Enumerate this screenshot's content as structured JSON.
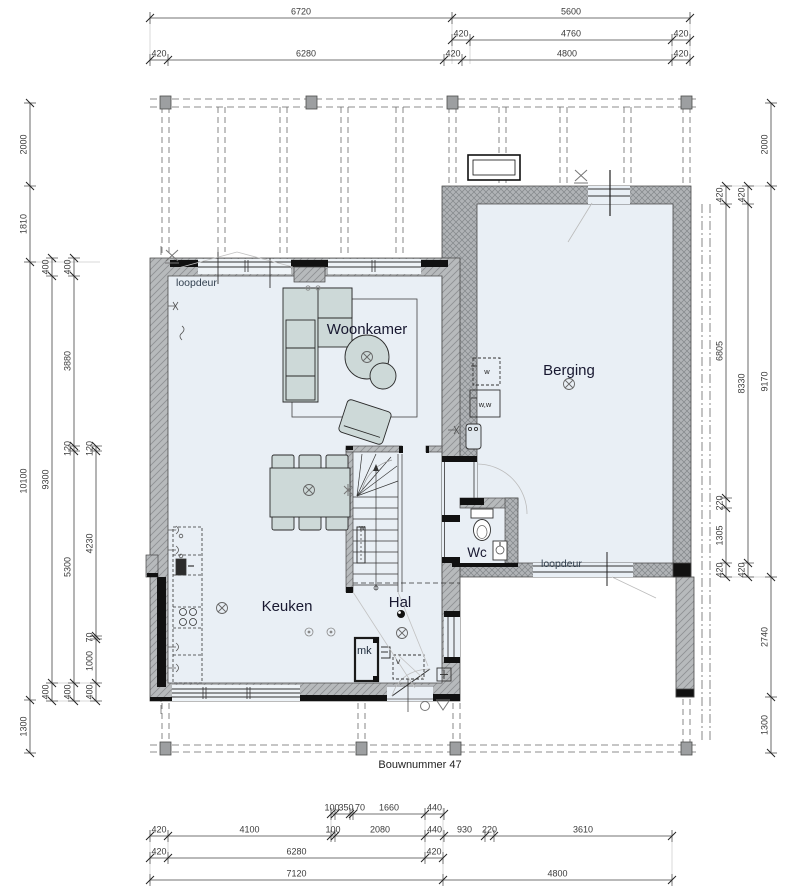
{
  "drawing": {
    "type": "floorplan-ground-floor",
    "building_label": "Bouwnummer 47"
  },
  "colors": {
    "floor": "#e9eff5",
    "wall_fill": "#b7babc",
    "wall_dark": "#111111",
    "furniture": "#cdd9d8",
    "dim_text": "#3b3b3b",
    "room_label": "#181830",
    "small_label": "#32404f"
  },
  "texts": [
    {
      "t": "Woonkamer",
      "x": 367,
      "y": 334,
      "s": 15,
      "c": "#181830",
      "n": "room-label-woonkamer"
    },
    {
      "t": "Berging",
      "x": 569,
      "y": 375,
      "s": 15,
      "c": "#181830",
      "n": "room-label-berging"
    },
    {
      "t": "Keuken",
      "x": 287,
      "y": 611,
      "s": 15,
      "c": "#181830",
      "n": "room-label-keuken"
    },
    {
      "t": "Hal",
      "x": 400,
      "y": 607,
      "s": 15,
      "c": "#181830",
      "n": "room-label-hal"
    },
    {
      "t": "Wc",
      "x": 477,
      "y": 557,
      "s": 13.5,
      "c": "#181830",
      "n": "room-label-wc"
    },
    {
      "t": "loopdeur",
      "x": 176,
      "y": 286,
      "s": 10.5,
      "c": "#32404f",
      "anchor": "start",
      "n": "label-loopdeur-front"
    },
    {
      "t": "loopdeur",
      "x": 541,
      "y": 567,
      "s": 10.5,
      "c": "#32404f",
      "anchor": "start",
      "n": "label-loopdeur-berging"
    },
    {
      "t": "mk",
      "x": 357,
      "y": 654,
      "s": 11,
      "c": "#1c2a3a",
      "anchor": "start",
      "n": "label-mk"
    },
    {
      "t": "v",
      "x": 396,
      "y": 664,
      "s": 8.5,
      "c": "#333333",
      "anchor": "start",
      "n": "label-v"
    },
    {
      "t": "w",
      "x": 487,
      "y": 374,
      "s": 7.5,
      "c": "#222222",
      "n": "label-w-appliance"
    },
    {
      "t": "w,w",
      "x": 485,
      "y": 407,
      "s": 7.5,
      "c": "#222222",
      "n": "label-ww-appliance"
    },
    {
      "t": "w",
      "x": 362,
      "y": 530,
      "s": 7,
      "c": "#222222",
      "n": "label-stair-w"
    },
    {
      "t": "Bouwnummer 47",
      "x": 420,
      "y": 768,
      "s": 11,
      "c": "#222222",
      "n": "label-bouwnummer"
    }
  ],
  "dimensions": {
    "chains": [
      {
        "name": "top-row-1",
        "orient": "h",
        "line": 18,
        "segs": [
          {
            "t": "6720",
            "a": 150,
            "b": 452
          },
          {
            "t": "5600",
            "a": 452,
            "b": 690
          }
        ]
      },
      {
        "name": "top-row-2",
        "orient": "h",
        "line": 40,
        "segs": [
          {
            "t": "420",
            "a": 452,
            "b": 470
          },
          {
            "t": "4760",
            "a": 470,
            "b": 672
          },
          {
            "t": "420",
            "a": 672,
            "b": 690
          }
        ]
      },
      {
        "name": "top-row-3",
        "orient": "h",
        "line": 60,
        "segs": [
          {
            "t": "420",
            "a": 150,
            "b": 168
          },
          {
            "t": "6280",
            "a": 168,
            "b": 444
          },
          {
            "t": "420",
            "a": 444,
            "b": 462
          },
          {
            "t": "4800",
            "a": 462,
            "b": 672
          },
          {
            "t": "420",
            "a": 672,
            "b": 690
          }
        ]
      },
      {
        "name": "bottom-row-1",
        "orient": "h",
        "line": 814,
        "segs": [
          {
            "t": "100",
            "a": 331,
            "b": 335,
            "lx": 332
          },
          {
            "t": "350",
            "a": 335,
            "b": 350,
            "lx": 346
          },
          {
            "t": "70",
            "a": 350,
            "b": 353,
            "lx": 360
          },
          {
            "t": "1660",
            "a": 353,
            "b": 425
          },
          {
            "t": "440",
            "a": 425,
            "b": 444
          }
        ]
      },
      {
        "name": "bottom-row-2",
        "orient": "h",
        "line": 836,
        "segs": [
          {
            "t": "420",
            "a": 150,
            "b": 168
          },
          {
            "t": "4100",
            "a": 168,
            "b": 331
          },
          {
            "t": "100",
            "a": 331,
            "b": 335
          },
          {
            "t": "2080",
            "a": 335,
            "b": 425
          },
          {
            "t": "440",
            "a": 425,
            "b": 444
          },
          {
            "t": "930",
            "a": 444,
            "b": 485
          },
          {
            "t": "220",
            "a": 485,
            "b": 494
          },
          {
            "t": "3610",
            "a": 494,
            "b": 672
          }
        ]
      },
      {
        "name": "bottom-row-3",
        "orient": "h",
        "line": 858,
        "segs": [
          {
            "t": "420",
            "a": 150,
            "b": 168
          },
          {
            "t": "6280",
            "a": 168,
            "b": 425
          },
          {
            "t": "420",
            "a": 425,
            "b": 443
          }
        ]
      },
      {
        "name": "bottom-row-4",
        "orient": "h",
        "line": 880,
        "segs": [
          {
            "t": "7120",
            "a": 150,
            "b": 443
          },
          {
            "t": "4800",
            "a": 443,
            "b": 672
          }
        ]
      },
      {
        "name": "left-col-1",
        "orient": "v",
        "line": 30,
        "segs": [
          {
            "t": "2000",
            "a": 103,
            "b": 186
          },
          {
            "t": "1810",
            "a": 186,
            "b": 262
          },
          {
            "t": "10100",
            "a": 262,
            "b": 700
          },
          {
            "t": "1300",
            "a": 700,
            "b": 753
          }
        ]
      },
      {
        "name": "left-col-2",
        "orient": "v",
        "line": 52,
        "segs": [
          {
            "t": "400",
            "a": 258,
            "b": 276
          },
          {
            "t": "9300",
            "a": 276,
            "b": 683
          },
          {
            "t": "400",
            "a": 683,
            "b": 701
          }
        ]
      },
      {
        "name": "left-col-3",
        "orient": "v",
        "line": 74,
        "segs": [
          {
            "t": "400",
            "a": 258,
            "b": 276
          },
          {
            "t": "3880",
            "a": 276,
            "b": 446
          },
          {
            "t": "120",
            "a": 446,
            "b": 451
          },
          {
            "t": "5300",
            "a": 451,
            "b": 683
          },
          {
            "t": "400",
            "a": 683,
            "b": 701
          }
        ]
      },
      {
        "name": "left-col-4",
        "orient": "v",
        "line": 96,
        "segs": [
          {
            "t": "120",
            "a": 446,
            "b": 451
          },
          {
            "t": "4230",
            "a": 451,
            "b": 636
          },
          {
            "t": "70",
            "a": 636,
            "b": 639
          },
          {
            "t": "1000",
            "a": 639,
            "b": 683
          },
          {
            "t": "400",
            "a": 683,
            "b": 701
          }
        ]
      },
      {
        "name": "right-col-1",
        "orient": "v",
        "line": 726,
        "segs": [
          {
            "t": "420",
            "a": 186,
            "b": 204
          },
          {
            "t": "6805",
            "a": 204,
            "b": 498
          },
          {
            "t": "220",
            "a": 498,
            "b": 508
          },
          {
            "t": "1305",
            "a": 508,
            "b": 563
          },
          {
            "t": "420",
            "a": 563,
            "b": 577
          }
        ]
      },
      {
        "name": "right-col-2",
        "orient": "v",
        "line": 748,
        "segs": [
          {
            "t": "420",
            "a": 186,
            "b": 204
          },
          {
            "t": "8330",
            "a": 204,
            "b": 563
          },
          {
            "t": "420",
            "a": 563,
            "b": 577
          }
        ]
      },
      {
        "name": "right-col-3",
        "orient": "v",
        "line": 771,
        "segs": [
          {
            "t": "2000",
            "a": 103,
            "b": 186
          },
          {
            "t": "9170",
            "a": 186,
            "b": 577
          },
          {
            "t": "2740",
            "a": 577,
            "b": 697
          },
          {
            "t": "1300",
            "a": 697,
            "b": 753
          }
        ]
      }
    ]
  }
}
